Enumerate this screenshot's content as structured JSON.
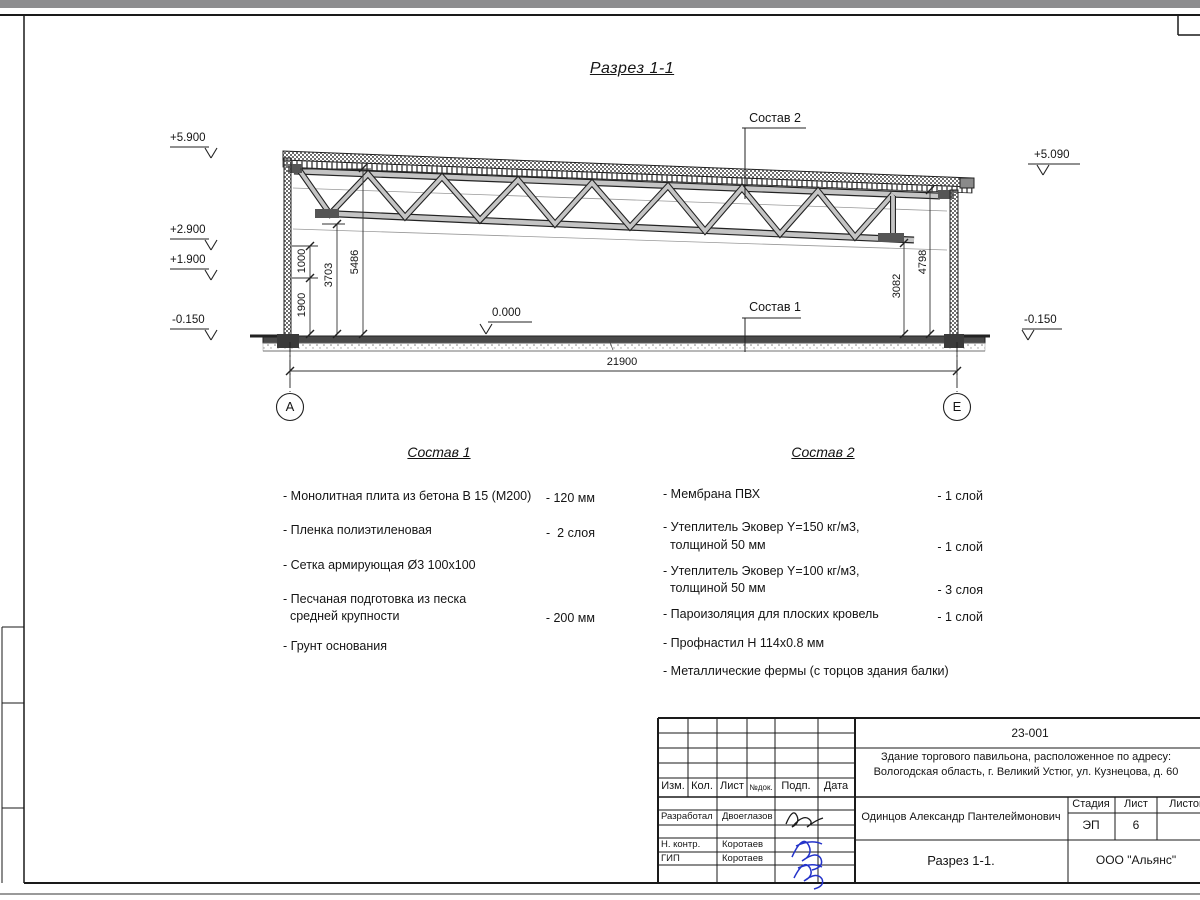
{
  "section": {
    "title": "Разрез 1-1",
    "elev_5900": "+5.900",
    "elev_2900": "+2.900",
    "elev_1900": "+1.900",
    "elev_left_minus": "-0.150",
    "elev_zero": "0.000",
    "elev_5090": "+5.090",
    "elev_right_minus": "-0.150",
    "dim_1900": "1900",
    "dim_1000": "1000",
    "dim_3703": "3703",
    "dim_5486": "5486",
    "dim_3082": "3082",
    "dim_4798": "4798",
    "dim_total": "21900",
    "axis_a": "А",
    "axis_e": "Е",
    "callout_sostav1": "Состав 1",
    "callout_sostav2": "Состав 2"
  },
  "sostav1": {
    "title": "Состав 1",
    "items": [
      {
        "name": "- Монолитная плита из бетона В 15 (М200)",
        "qty": "- 120 мм"
      },
      {
        "name": "- Пленка полиэтиленовая",
        "qty": "-  2 слоя"
      },
      {
        "name": "- Сетка армирующая Ø3 100х100",
        "qty": ""
      },
      {
        "name": "- Песчаная подготовка из песка\n  средней крупности",
        "qty": "- 200 мм"
      },
      {
        "name": "- Грунт основания",
        "qty": ""
      }
    ]
  },
  "sostav2": {
    "title": "Состав 2",
    "items": [
      {
        "name": "- Мембрана ПВХ",
        "qty": "- 1 слой"
      },
      {
        "name": "- Утеплитель Эковер Y=150 кг/м3,\n  толщиной 50 мм",
        "qty": "- 1 слой"
      },
      {
        "name": "- Утеплитель Эковер Y=100 кг/м3,\n  толщиной 50 мм",
        "qty": "- 3 слоя"
      },
      {
        "name": "- Пароизоляция для плоских кровель",
        "qty": "- 1 слой"
      },
      {
        "name": "- Профнастил Н 114х0.8 мм",
        "qty": ""
      },
      {
        "name": "- Металлические фермы (с торцов здания балки)",
        "qty": ""
      }
    ]
  },
  "titleblock": {
    "doc_number": "23-001",
    "object_line1": "Здание торгового павильона, расположенное по адресу:",
    "object_line2": "Вологодская область, г. Великий Устюг, ул. Кузнецова, д. 60",
    "col_izm": "Изм.",
    "col_kol": "Кол.",
    "col_list": "Лист",
    "col_ndok": "№док.",
    "col_podp": "Подп.",
    "col_data": "Дата",
    "row1_role": "Разработал",
    "row1_name": "Двоеглазов",
    "row2_role": "Н. контр.",
    "row2_name": "Коротаев",
    "row3_role": "ГИП",
    "row3_name": "Коротаев",
    "chief": "Одинцов Александр Пантелеймонович",
    "stage_label": "Стадия",
    "sheet_label": "Лист",
    "sheets_label": "Листов",
    "stage": "ЭП",
    "sheet_num": "6",
    "sheet_title": "Разрез 1-1.",
    "company": "ООО \"Альянс\""
  }
}
